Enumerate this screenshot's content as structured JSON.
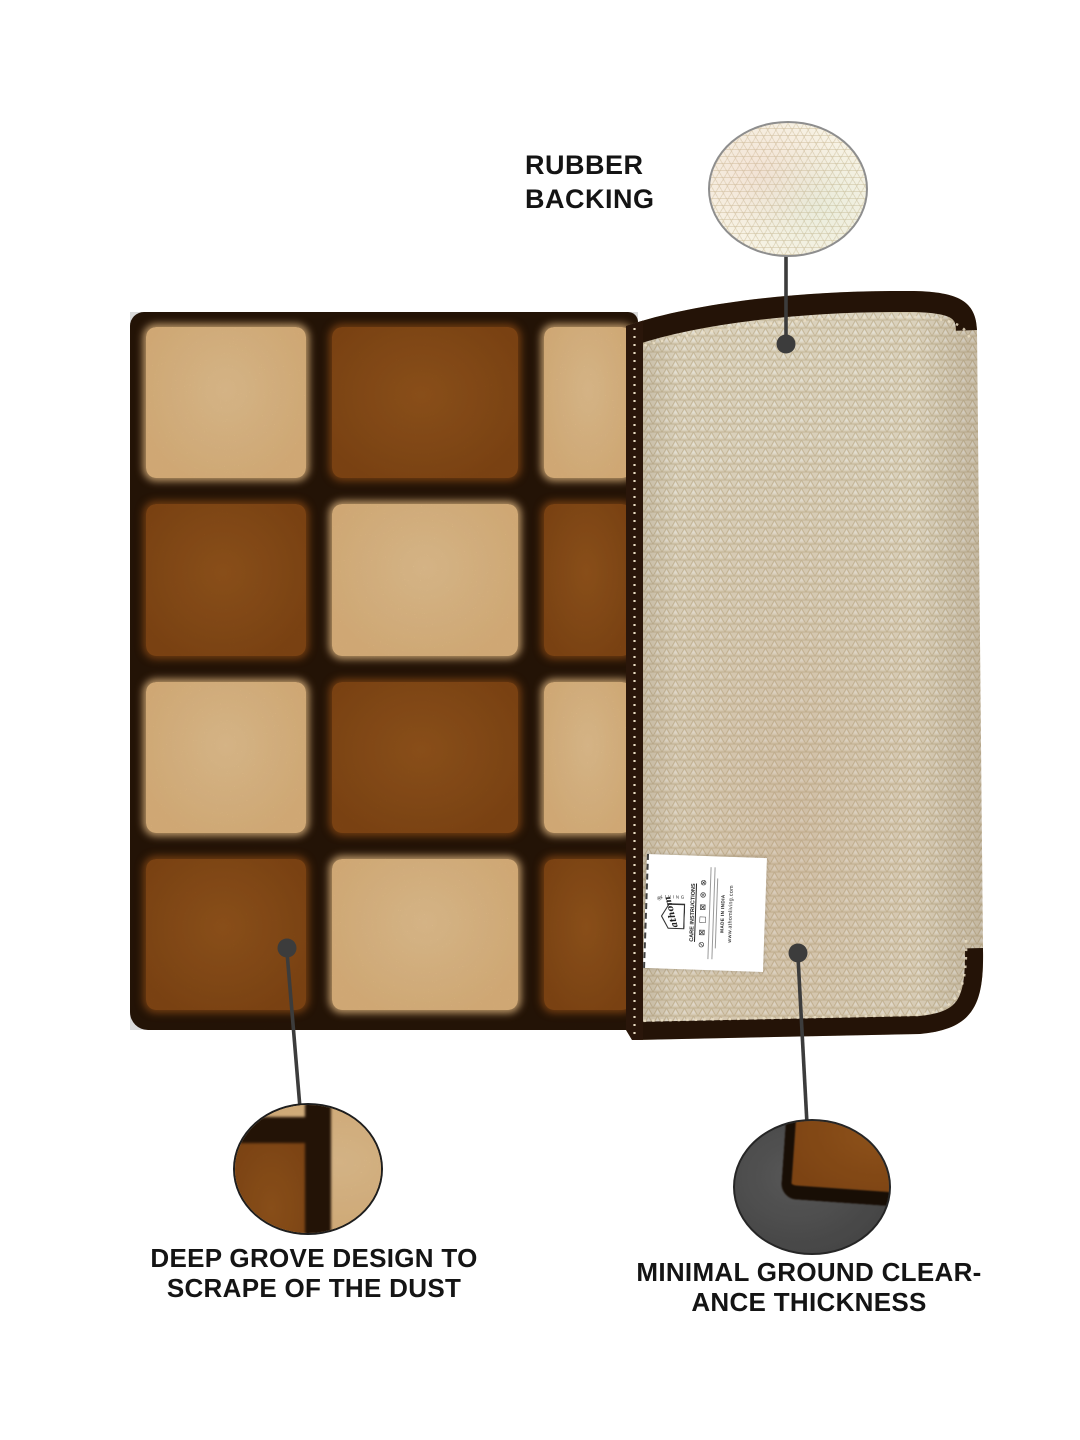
{
  "colors": {
    "canvas_bg": "#ffffff",
    "text": "#141414",
    "callout_line": "#3c3c3c",
    "mat_dark": "#2a1708",
    "mat_band": "#241307",
    "square_tan": "#f2c488",
    "square_tan_hi": "#f8d29c",
    "square_brown": "#8e4d16",
    "square_brown_hi": "#a05c1e",
    "backing_base": "#ede3cc",
    "backing_line": "#d5c6a4",
    "backing_hi": "#f7f2e4",
    "circle_border_gray": "#8e8e8e",
    "clearance_circle_bg": "#4e4e4e",
    "label_bg": "#ffffff"
  },
  "callouts": {
    "rubber_backing": {
      "line1": "RUBBER",
      "line2": "BACKING"
    },
    "deep_groove": {
      "line1": "DEEP GROVE DESIGN TO",
      "line2": "SCRAPE OF THE DUST"
    },
    "ground_clearance": {
      "line1": "MINIMAL GROUND CLEAR-",
      "line2": "ANCE THICKNESS"
    }
  },
  "label_tag": {
    "brand": "athom",
    "registered": "®",
    "brand_sub": "LIVING",
    "care_heading": "CARE INSTRUCTIONS",
    "care_symbols": "⊘ ⊠ □ ⊠ ⊛ ⊗",
    "made_in": "MADE IN INDIA",
    "website": "www.athomliving.com"
  },
  "mat": {
    "pattern": [
      [
        "tan",
        "brown",
        "tan"
      ],
      [
        "brown",
        "tan",
        "brown"
      ],
      [
        "tan",
        "brown",
        "tan"
      ],
      [
        "brown",
        "tan",
        "brown"
      ]
    ]
  }
}
